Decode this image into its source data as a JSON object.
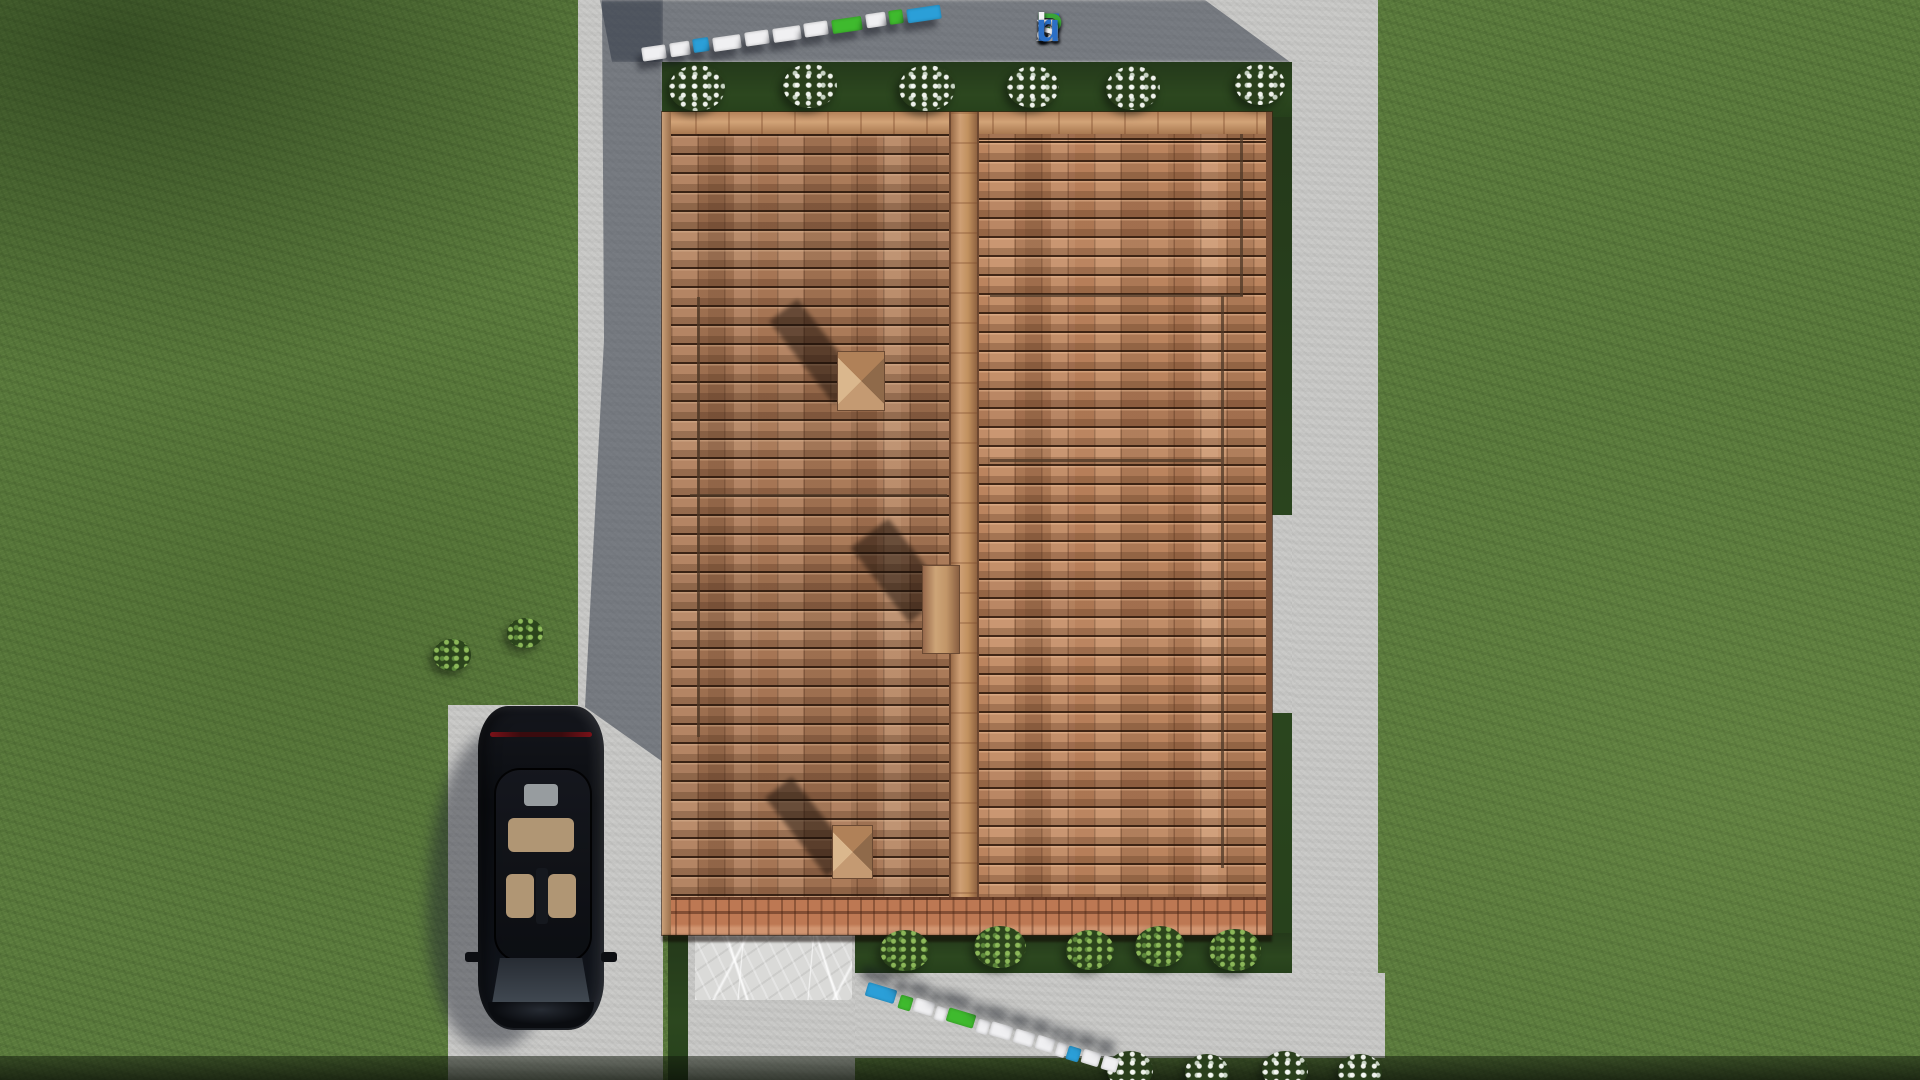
{
  "watermark": {
    "text": "FixPlans.ru",
    "letters": [
      {
        "ch": "F",
        "color": "#2b6fc6"
      },
      {
        "ch": "i",
        "color": "#3aa437"
      },
      {
        "ch": "x",
        "color": "#e9e9ec"
      },
      {
        "ch": "P",
        "color": "#3aa437"
      },
      {
        "ch": "l",
        "color": "#f2f2f4"
      },
      {
        "ch": "a",
        "color": "#f2f2f4"
      },
      {
        "ch": "n",
        "color": "#f2f2f4"
      },
      {
        "ch": "s",
        "color": "#f2f2f4"
      },
      {
        "ch": ".",
        "color": "#f2f2f4"
      },
      {
        "ch": "r",
        "color": "#2b6fc6"
      },
      {
        "ch": "u",
        "color": "#2b6fc6"
      }
    ]
  },
  "palette": {
    "logo_blue": "#2b9fd8",
    "logo_green": "#3fba2e",
    "logo_white": "#f0f0f2",
    "grass": "#5a7a3c",
    "grass_shade": "#2c471f",
    "concrete": "#c9c9c7",
    "concrete_shadow": "#2c3442",
    "roof_tile": "#b27e5a",
    "roof_ridge": "#cf9b6f",
    "marble": "#dadad8",
    "car_paint": "#0b0d11",
    "car_interior": "#b09674"
  },
  "strips": {
    "top": {
      "start_x": 642,
      "start_y": 46,
      "angle_deg": -8.3,
      "blocks": [
        {
          "t": 0,
          "w": 24,
          "c": "white"
        },
        {
          "t": 28,
          "w": 20,
          "c": "white"
        },
        {
          "t": 52,
          "w": 16,
          "c": "blue"
        },
        {
          "t": 72,
          "w": 28,
          "c": "white"
        },
        {
          "t": 104,
          "w": 24,
          "c": "white"
        },
        {
          "t": 132,
          "w": 28,
          "c": "white"
        },
        {
          "t": 164,
          "w": 24,
          "c": "white"
        },
        {
          "t": 192,
          "w": 30,
          "c": "green"
        },
        {
          "t": 226,
          "w": 20,
          "c": "white"
        },
        {
          "t": 250,
          "w": 14,
          "c": "green"
        },
        {
          "t": 268,
          "w": 34,
          "c": "blue"
        }
      ]
    },
    "bottom": {
      "start_x": 866,
      "start_y": 986,
      "angle_deg": 16.8,
      "blocks": [
        {
          "t": 0,
          "w": 30,
          "c": "blue"
        },
        {
          "t": 34,
          "w": 13,
          "c": "green"
        },
        {
          "t": 50,
          "w": 20,
          "c": "white"
        },
        {
          "t": 72,
          "w": 11,
          "c": "white"
        },
        {
          "t": 85,
          "w": 28,
          "c": "green"
        },
        {
          "t": 116,
          "w": 12,
          "c": "white"
        },
        {
          "t": 130,
          "w": 22,
          "c": "white"
        },
        {
          "t": 155,
          "w": 20,
          "c": "white"
        },
        {
          "t": 178,
          "w": 18,
          "c": "white"
        },
        {
          "t": 198,
          "w": 10,
          "c": "white"
        },
        {
          "t": 210,
          "w": 13,
          "c": "blue"
        },
        {
          "t": 226,
          "w": 18,
          "c": "white"
        },
        {
          "t": 246,
          "w": 16,
          "c": "white"
        }
      ]
    }
  },
  "bushes": {
    "top_white": [
      {
        "x": 697,
        "y": 88,
        "s": 56
      },
      {
        "x": 810,
        "y": 86,
        "s": 54
      },
      {
        "x": 927,
        "y": 88,
        "s": 56
      },
      {
        "x": 1033,
        "y": 87,
        "s": 52
      },
      {
        "x": 1133,
        "y": 88,
        "s": 54
      },
      {
        "x": 1260,
        "y": 84,
        "s": 50
      }
    ],
    "bottom_green": [
      {
        "x": 905,
        "y": 950,
        "s": 50
      },
      {
        "x": 1000,
        "y": 947,
        "s": 52
      },
      {
        "x": 1090,
        "y": 950,
        "s": 48
      },
      {
        "x": 1160,
        "y": 946,
        "s": 50
      },
      {
        "x": 1235,
        "y": 950,
        "s": 52
      }
    ],
    "edge_white": [
      {
        "x": 1130,
        "y": 1070,
        "s": 46
      },
      {
        "x": 1207,
        "y": 1072,
        "s": 44
      },
      {
        "x": 1285,
        "y": 1070,
        "s": 46
      },
      {
        "x": 1360,
        "y": 1072,
        "s": 44
      }
    ],
    "driveway_green": [
      {
        "x": 452,
        "y": 655,
        "s": 38
      },
      {
        "x": 525,
        "y": 633,
        "s": 36
      }
    ]
  }
}
